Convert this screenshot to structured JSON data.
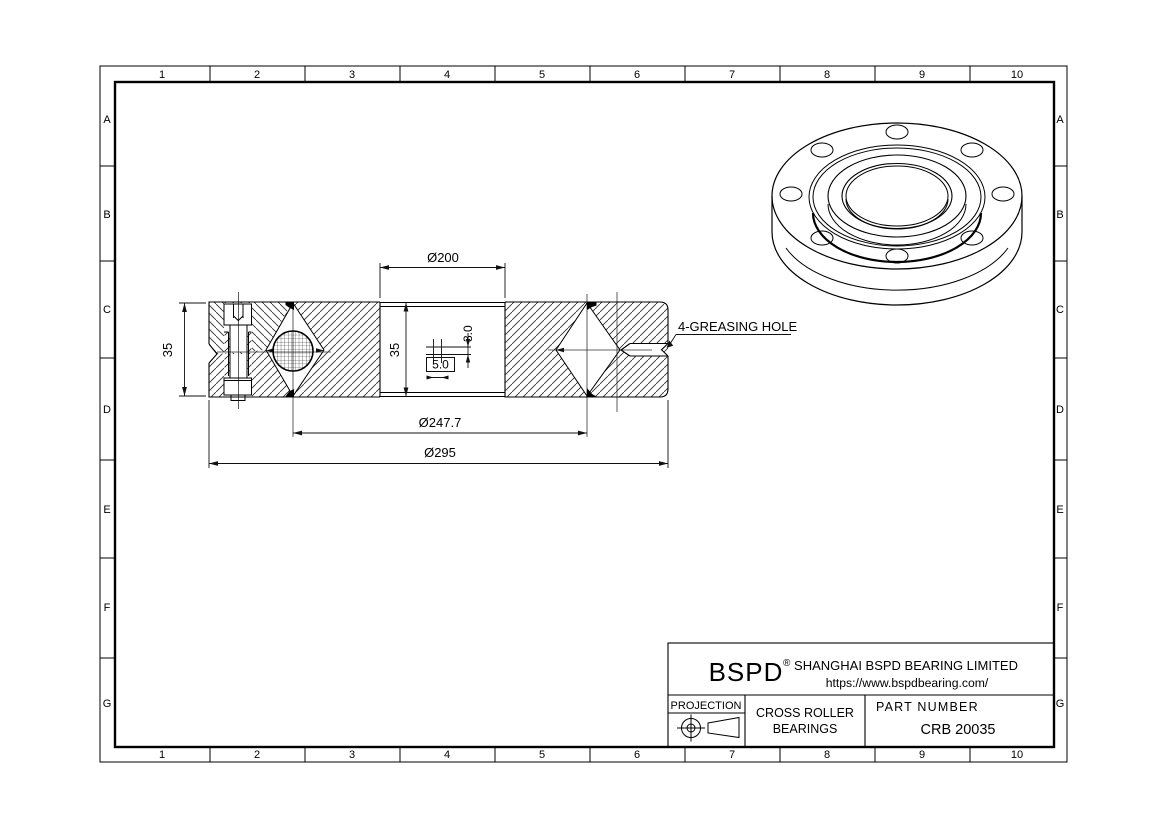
{
  "frame": {
    "columns": [
      "1",
      "2",
      "3",
      "4",
      "5",
      "6",
      "7",
      "8",
      "9",
      "10"
    ],
    "rows": [
      "A",
      "B",
      "C",
      "D",
      "E",
      "F",
      "G"
    ]
  },
  "dims": {
    "bore_dia": "Ø200",
    "pitch_dia": "Ø247.7",
    "outer_dia": "Ø295",
    "width_left": "35",
    "width_bore": "35",
    "grease_hole_h": "3.0",
    "grease_hole_w": "5.0",
    "grease_label": "4-GREASING HOLE"
  },
  "title_block": {
    "brand": "BSPD",
    "reg_mark": "®",
    "company": "SHANGHAI BSPD BEARING LIMITED",
    "website": "https://www.bspdbearing.com/",
    "projection_label": "PROJECTION",
    "product_line1": "CROSS ROLLER",
    "product_line2": "BEARINGS",
    "part_number_label": "PART  NUMBER",
    "part_number": "CRB 20035"
  }
}
